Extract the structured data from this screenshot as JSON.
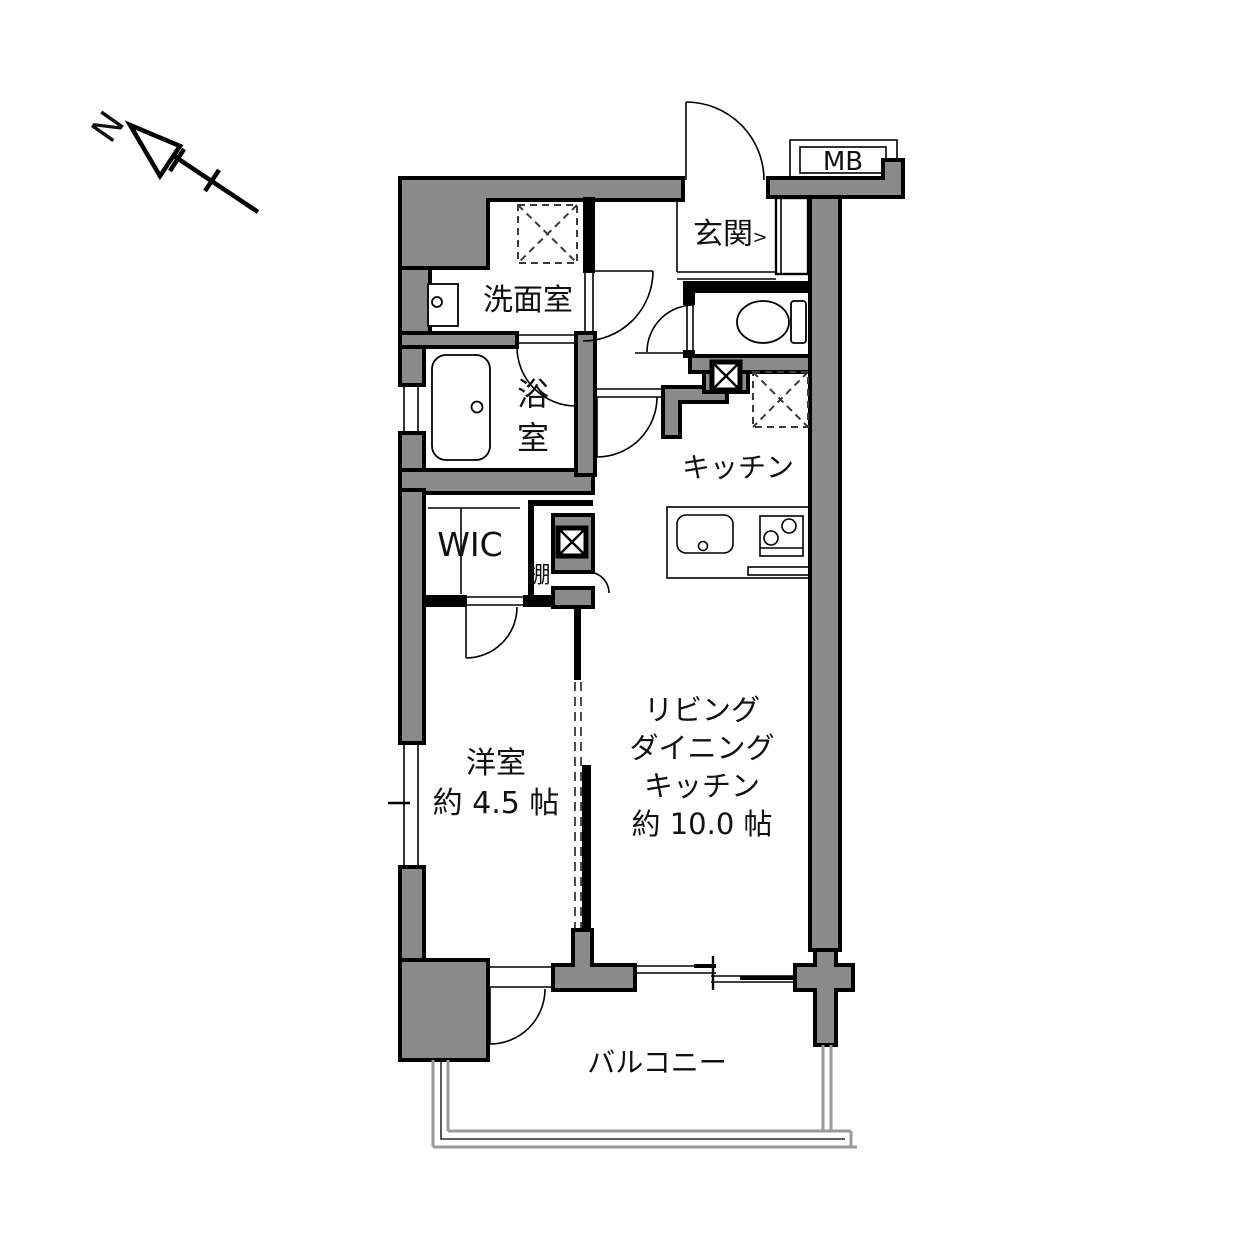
{
  "compass": {
    "label": "N"
  },
  "plan": {
    "entrance": {
      "label": "玄関",
      "marker": ">"
    },
    "meter_box": {
      "label": "MB"
    },
    "washroom": {
      "label": "洗面室"
    },
    "bathroom": {
      "chars": [
        "浴",
        "室"
      ]
    },
    "wic": {
      "label": "WIC"
    },
    "shelf": {
      "label": "棚"
    },
    "kitchen": {
      "label": "キッチン"
    },
    "ldk": {
      "lines": [
        "リビング",
        "ダイニング",
        "キッチン",
        "約 10.0 帖"
      ]
    },
    "western_room": {
      "lines": [
        "洋室",
        "約 4.5 帖"
      ]
    },
    "balcony": {
      "label": "バルコニー"
    }
  },
  "colors": {
    "wall": "#8a8a8a",
    "line": "#000000",
    "rail": "#9a9a9a",
    "dashc": "#3a3a3a",
    "bg": "#ffffff"
  }
}
